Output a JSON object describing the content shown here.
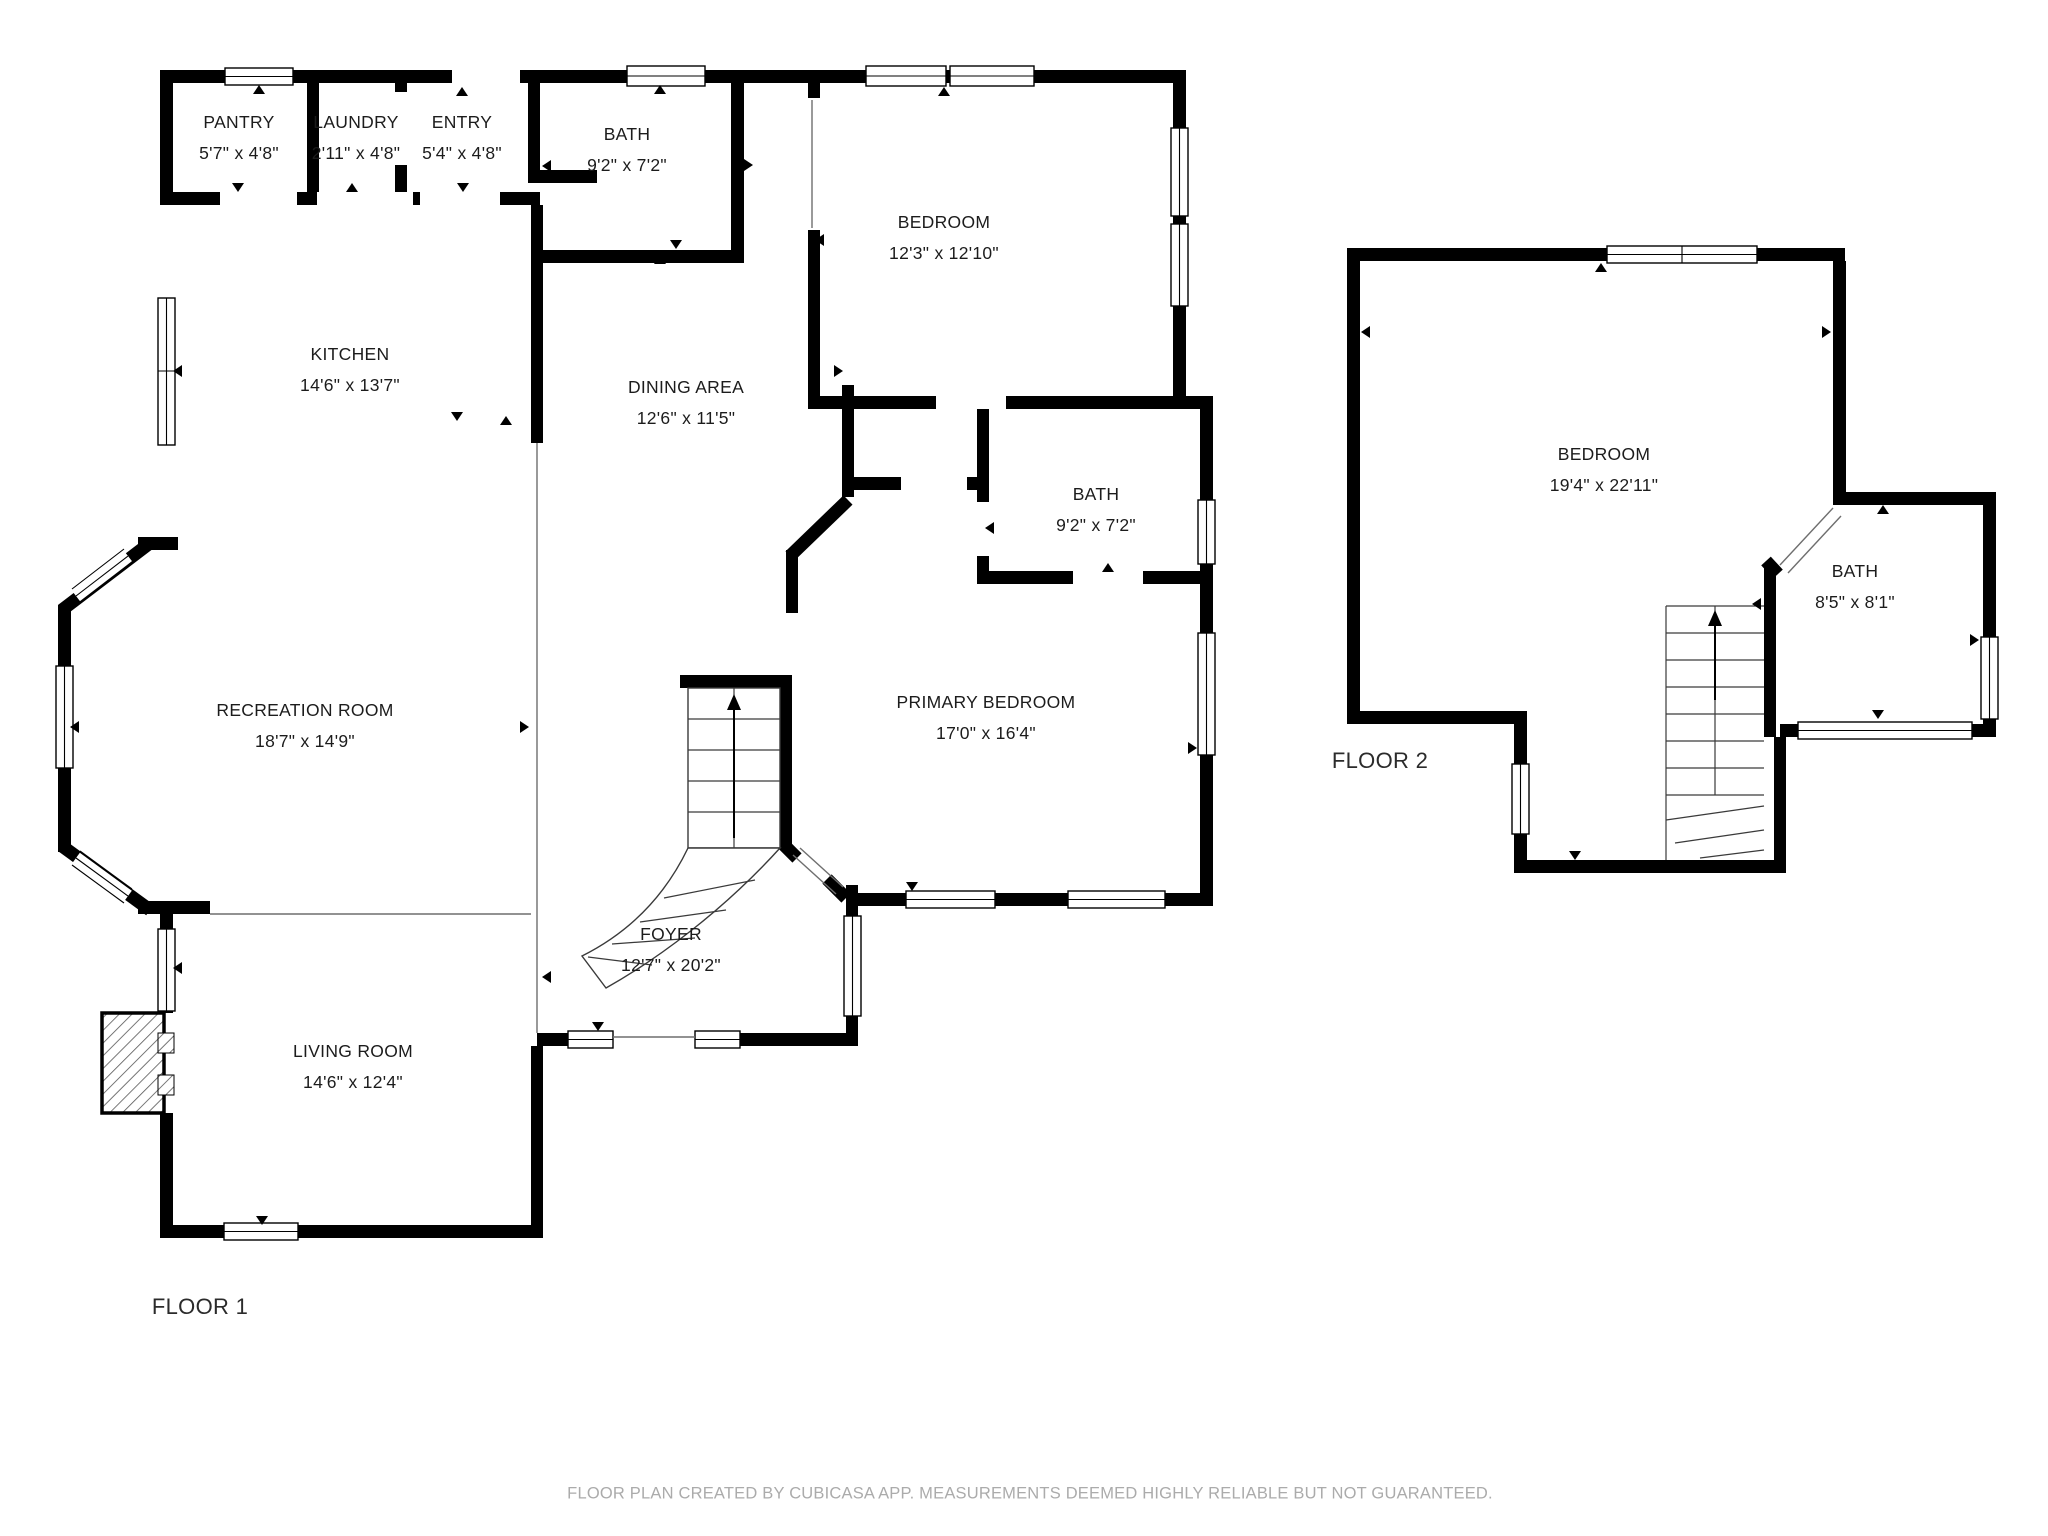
{
  "colors": {
    "background": "#ffffff",
    "wall": "#000000",
    "thin_line": "#6e6e6e",
    "label_text": "#1c1c1c",
    "floor_label_text": "#2b2b2b",
    "disclaimer_text": "#ababab"
  },
  "floors": [
    {
      "id": "floor-1",
      "label": "FLOOR 1",
      "label_cx": 200,
      "label_cy": 1307,
      "rooms": [
        {
          "id": "pantry",
          "name": "PANTRY",
          "dims": "5'7\" x 4'8\"",
          "cx": 239,
          "cy": 138
        },
        {
          "id": "laundry",
          "name": "LAUNDRY",
          "dims": "2'11\" x 4'8\"",
          "cx": 356,
          "cy": 138
        },
        {
          "id": "entry",
          "name": "ENTRY",
          "dims": "5'4\" x 4'8\"",
          "cx": 462,
          "cy": 138
        },
        {
          "id": "bath",
          "name": "BATH",
          "dims": "9'2\" x 7'2\"",
          "cx": 627,
          "cy": 150
        },
        {
          "id": "bedroom",
          "name": "BEDROOM",
          "dims": "12'3\" x 12'10\"",
          "cx": 944,
          "cy": 238
        },
        {
          "id": "kitchen",
          "name": "KITCHEN",
          "dims": "14'6\" x 13'7\"",
          "cx": 350,
          "cy": 370
        },
        {
          "id": "dining-area",
          "name": "DINING AREA",
          "dims": "12'6\" x 11'5\"",
          "cx": 686,
          "cy": 403
        },
        {
          "id": "bath-2",
          "name": "BATH",
          "dims": "9'2\" x 7'2\"",
          "cx": 1096,
          "cy": 510
        },
        {
          "id": "recreation-room",
          "name": "RECREATION ROOM",
          "dims": "18'7\" x 14'9\"",
          "cx": 305,
          "cy": 726
        },
        {
          "id": "primary-bedroom",
          "name": "PRIMARY BEDROOM",
          "dims": "17'0\" x 16'4\"",
          "cx": 986,
          "cy": 718
        },
        {
          "id": "foyer",
          "name": "FOYER",
          "dims": "12'7\" x 20'2\"",
          "cx": 671,
          "cy": 950
        },
        {
          "id": "living-room",
          "name": "LIVING ROOM",
          "dims": "14'6\" x 12'4\"",
          "cx": 353,
          "cy": 1067
        }
      ]
    },
    {
      "id": "floor-2",
      "label": "FLOOR 2",
      "label_cx": 1380,
      "label_cy": 761,
      "rooms": [
        {
          "id": "bedroom-2",
          "name": "BEDROOM",
          "dims": "19'4\" x 22'11\"",
          "cx": 1604,
          "cy": 470
        },
        {
          "id": "bath-3",
          "name": "BATH",
          "dims": "8'5\" x 8'1\"",
          "cx": 1855,
          "cy": 587
        }
      ]
    }
  ],
  "footer": {
    "disclaimer": "FLOOR PLAN CREATED BY CUBICASA APP. MEASUREMENTS DEEMED HIGHLY RELIABLE BUT NOT GUARANTEED."
  }
}
